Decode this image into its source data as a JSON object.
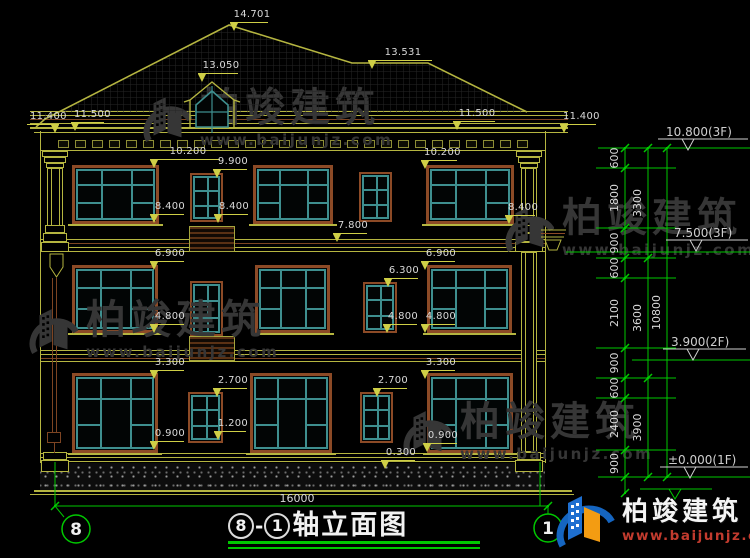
{
  "drawing_title": {
    "axis_start": "8",
    "separator": "-",
    "axis_end": "1",
    "name": "轴立面图"
  },
  "axis_bubbles": {
    "left": "8",
    "right": "1"
  },
  "overall_dimension": "16000",
  "watermark": {
    "brand": "柏竣建筑",
    "url": "www.baijunjz.com"
  },
  "vendor_logo": {
    "brand": "柏竣建筑",
    "url": "www.baijunjz.com"
  },
  "colors": {
    "cad_yellow": "#b5b540",
    "cad_flag_yellow": "#cfcf46",
    "cad_brown": "#8c4a26",
    "cad_teal": "#3e8f8f",
    "cad_green": "#00c800",
    "dim_text": "#d9d9d9",
    "watermark_gray": "#363636",
    "logo_blue": "#1565c0",
    "logo_orange": "#f39c12",
    "logo_red": "#c23b2e"
  },
  "level_markers": [
    {
      "text": "10.800(3F)",
      "tx": 666,
      "ty": 136,
      "lx1": 658,
      "lx2": 748,
      "ly": 139,
      "ax": 688,
      "ay": 150
    },
    {
      "text": "7.500(3F)",
      "tx": 674,
      "ty": 237,
      "lx1": 666,
      "lx2": 748,
      "ly": 240,
      "ax": 696,
      "ay": 251
    },
    {
      "text": "3.900(2F)",
      "tx": 671,
      "ty": 346,
      "lx1": 663,
      "lx2": 746,
      "ly": 349,
      "ax": 693,
      "ay": 360
    },
    {
      "text": "±0.000(1F)",
      "tx": 668,
      "ty": 464,
      "lx1": 660,
      "lx2": 748,
      "ly": 467,
      "ax": 690,
      "ay": 478
    }
  ],
  "dim_chain_inner": [
    {
      "text": "600",
      "y1": 148,
      "y2": 168
    },
    {
      "text": "1800",
      "y1": 168,
      "y2": 228
    },
    {
      "text": "900",
      "y1": 228,
      "y2": 258
    },
    {
      "text": "600",
      "y1": 258,
      "y2": 278
    },
    {
      "text": "2100",
      "y1": 278,
      "y2": 348
    },
    {
      "text": "900",
      "y1": 348,
      "y2": 378
    },
    {
      "text": "600",
      "y1": 378,
      "y2": 398
    },
    {
      "text": "2400",
      "y1": 398,
      "y2": 450
    },
    {
      "text": "900",
      "y1": 450,
      "y2": 477
    }
  ],
  "dim_chain_middle": [
    {
      "text": "3300",
      "y1": 148,
      "y2": 258
    },
    {
      "text": "3600",
      "y1": 258,
      "y2": 378
    },
    {
      "text": "3900",
      "y1": 378,
      "y2": 477
    }
  ],
  "dim_chain_outer": [
    {
      "text": "10800",
      "y1": 148,
      "y2": 477
    }
  ],
  "elevation_callouts": [
    {
      "t": "14.701",
      "x": 230,
      "y": 22,
      "w": 38,
      "tri": "l"
    },
    {
      "t": "13.531",
      "x": 368,
      "y": 60,
      "w": 64,
      "tri": "l"
    },
    {
      "t": "13.050",
      "x": 198,
      "y": 73,
      "w": 40,
      "tri": "l"
    },
    {
      "t": "11.400",
      "x": 27,
      "y": 124,
      "w": 32,
      "tri": "r"
    },
    {
      "t": "11.500",
      "x": 71,
      "y": 122,
      "w": 33,
      "tri": "l"
    },
    {
      "t": "11.500",
      "x": 453,
      "y": 121,
      "w": 42,
      "tri": "l"
    },
    {
      "t": "11.400",
      "x": 560,
      "y": 124,
      "w": 36,
      "tri": "l"
    },
    {
      "t": "10.200",
      "x": 150,
      "y": 159,
      "w": 70,
      "tri": "l"
    },
    {
      "t": "10.200",
      "x": 421,
      "y": 160,
      "w": 36,
      "tri": "l"
    },
    {
      "t": "9.900",
      "x": 213,
      "y": 169,
      "w": 34,
      "tri": "l"
    },
    {
      "t": "8.400",
      "x": 150,
      "y": 214,
      "w": 34,
      "tri": "l"
    },
    {
      "t": "8.400",
      "x": 214,
      "y": 214,
      "w": 34,
      "tri": "l"
    },
    {
      "t": "8.400",
      "x": 505,
      "y": 215,
      "w": 30,
      "tri": "l"
    },
    {
      "t": "7.800",
      "x": 333,
      "y": 233,
      "w": 34,
      "tri": "l"
    },
    {
      "t": "6.900",
      "x": 150,
      "y": 261,
      "w": 34,
      "tri": "l"
    },
    {
      "t": "6.900",
      "x": 421,
      "y": 261,
      "w": 34,
      "tri": "l"
    },
    {
      "t": "6.300",
      "x": 384,
      "y": 278,
      "w": 34,
      "tri": "l"
    },
    {
      "t": "4.800",
      "x": 150,
      "y": 324,
      "w": 34,
      "tri": "l"
    },
    {
      "t": "4.800",
      "x": 383,
      "y": 324,
      "w": 34,
      "tri": "l"
    },
    {
      "t": "4.800",
      "x": 421,
      "y": 324,
      "w": 34,
      "tri": "l"
    },
    {
      "t": "3.300",
      "x": 150,
      "y": 370,
      "w": 34,
      "tri": "l"
    },
    {
      "t": "3.300",
      "x": 421,
      "y": 370,
      "w": 34,
      "tri": "l"
    },
    {
      "t": "2.700",
      "x": 213,
      "y": 388,
      "w": 34,
      "tri": "l"
    },
    {
      "t": "2.700",
      "x": 373,
      "y": 388,
      "w": 34,
      "tri": "l"
    },
    {
      "t": "1.200",
      "x": 214,
      "y": 431,
      "w": 32,
      "tri": "l"
    },
    {
      "t": "0.900",
      "x": 150,
      "y": 441,
      "w": 34,
      "tri": "l"
    },
    {
      "t": "0.900",
      "x": 423,
      "y": 443,
      "w": 34,
      "tri": "l"
    },
    {
      "t": "0.300",
      "x": 381,
      "y": 460,
      "w": 34,
      "tri": "l"
    }
  ]
}
